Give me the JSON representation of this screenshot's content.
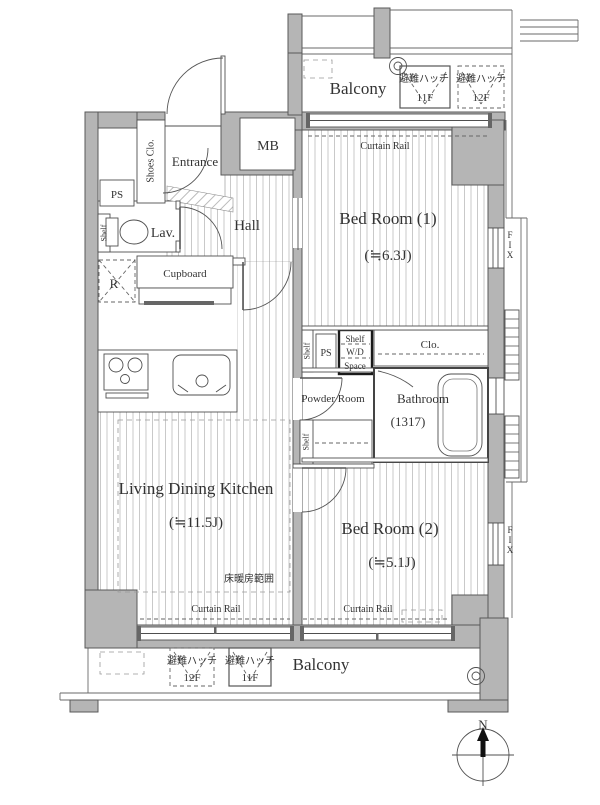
{
  "rooms": {
    "balcony_top": {
      "label": "Balcony"
    },
    "bedroom1": {
      "label": "Bed Room (1)",
      "size": "(≒6.3J)"
    },
    "hall": {
      "label": "Hall"
    },
    "entrance": {
      "label": "Entrance"
    },
    "lav": {
      "label": "Lav."
    },
    "ldk": {
      "label": "Living Dining Kitchen",
      "size": "(≒11.5J)"
    },
    "powder": {
      "label": "Powder Room"
    },
    "bathroom": {
      "label": "Bathroom",
      "size": "(1317)"
    },
    "bedroom2": {
      "label": "Bed Room (2)",
      "size": "(≒5.1J)"
    },
    "balcony_bottom": {
      "label": "Balcony"
    }
  },
  "fixtures": {
    "mb": "MB",
    "ps_top": "PS",
    "ps_mid": "PS",
    "shoes_closet": "Shoes Clo.",
    "cupboard": "Cupboard",
    "refrigerator": "R",
    "shelf_lav": "Shelf",
    "shelf_mid": "Shelf",
    "shelf_powder": "Shelf",
    "wd_space": {
      "line1": "Shelf",
      "line2": "W/D",
      "line3": "Space"
    },
    "closet": "Clo.",
    "fix_window_upper": "FIX",
    "fix_window_lower": "FIX",
    "curtain_rail_bedroom1": "Curtain Rail",
    "curtain_rail_ldk": "Curtain Rail",
    "curtain_rail_bedroom2": "Curtain Rail",
    "floor_heating_area": "床暖房範囲"
  },
  "escape_hatches": {
    "top_inner": {
      "label": "避難ハッチ",
      "floor": "11F"
    },
    "top_outer": {
      "label": "避難ハッチ",
      "floor": "12F"
    },
    "bottom_outer": {
      "label": "避難ハッチ",
      "floor": "12F"
    },
    "bottom_inner": {
      "label": "避難ハッチ",
      "floor": "11F"
    }
  },
  "compass": {
    "north_label": "N"
  },
  "colors": {
    "wall_fill": "#b5b5b5",
    "line": "#4f4f4f",
    "hatch_line": "#c9c9c9",
    "text": "#333333"
  }
}
